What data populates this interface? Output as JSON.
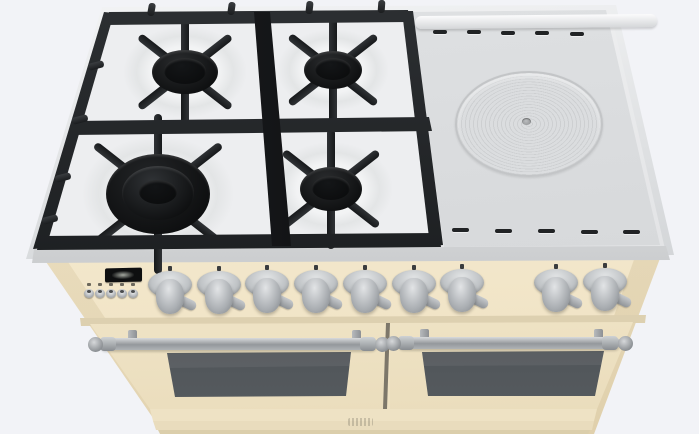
{
  "scene": {
    "type": "3d-product-render",
    "subject": "freestanding dual-fuel range cooker viewed from the front-top",
    "background_color": "#f2f3f7"
  },
  "cooktop": {
    "surface_color": "#e4e5e7",
    "gas_section": {
      "burner_count": 4,
      "grate_color": "#1d1f21",
      "burners": [
        {
          "name": "rear-left-burner",
          "size": "medium"
        },
        {
          "name": "rear-right-burner",
          "size": "medium"
        },
        {
          "name": "front-left-burner",
          "size": "large-multi-ring"
        },
        {
          "name": "front-right-burner",
          "size": "medium"
        }
      ]
    },
    "griddle_section": {
      "name": "solid-griddle-plate",
      "plate_color": "#d7d9db",
      "ring_pattern": true,
      "vent_slots_back": 5,
      "vent_slots_front": 5,
      "handle_rail": true
    }
  },
  "control_panel": {
    "panel_color": "#f5ecd4",
    "clock_display": {
      "name": "clock-display",
      "bg_color": "#0e0f10",
      "text": ""
    },
    "clock_button_count": 5,
    "knob_count": 9,
    "knob_color": "#c3c6c9"
  },
  "ovens": {
    "door_count": 2,
    "door_color": "#f3e8cd",
    "handle_color": "#9da1a5",
    "window_color": "#43474b",
    "badge": {
      "name": "brand-badge",
      "text": ""
    }
  }
}
